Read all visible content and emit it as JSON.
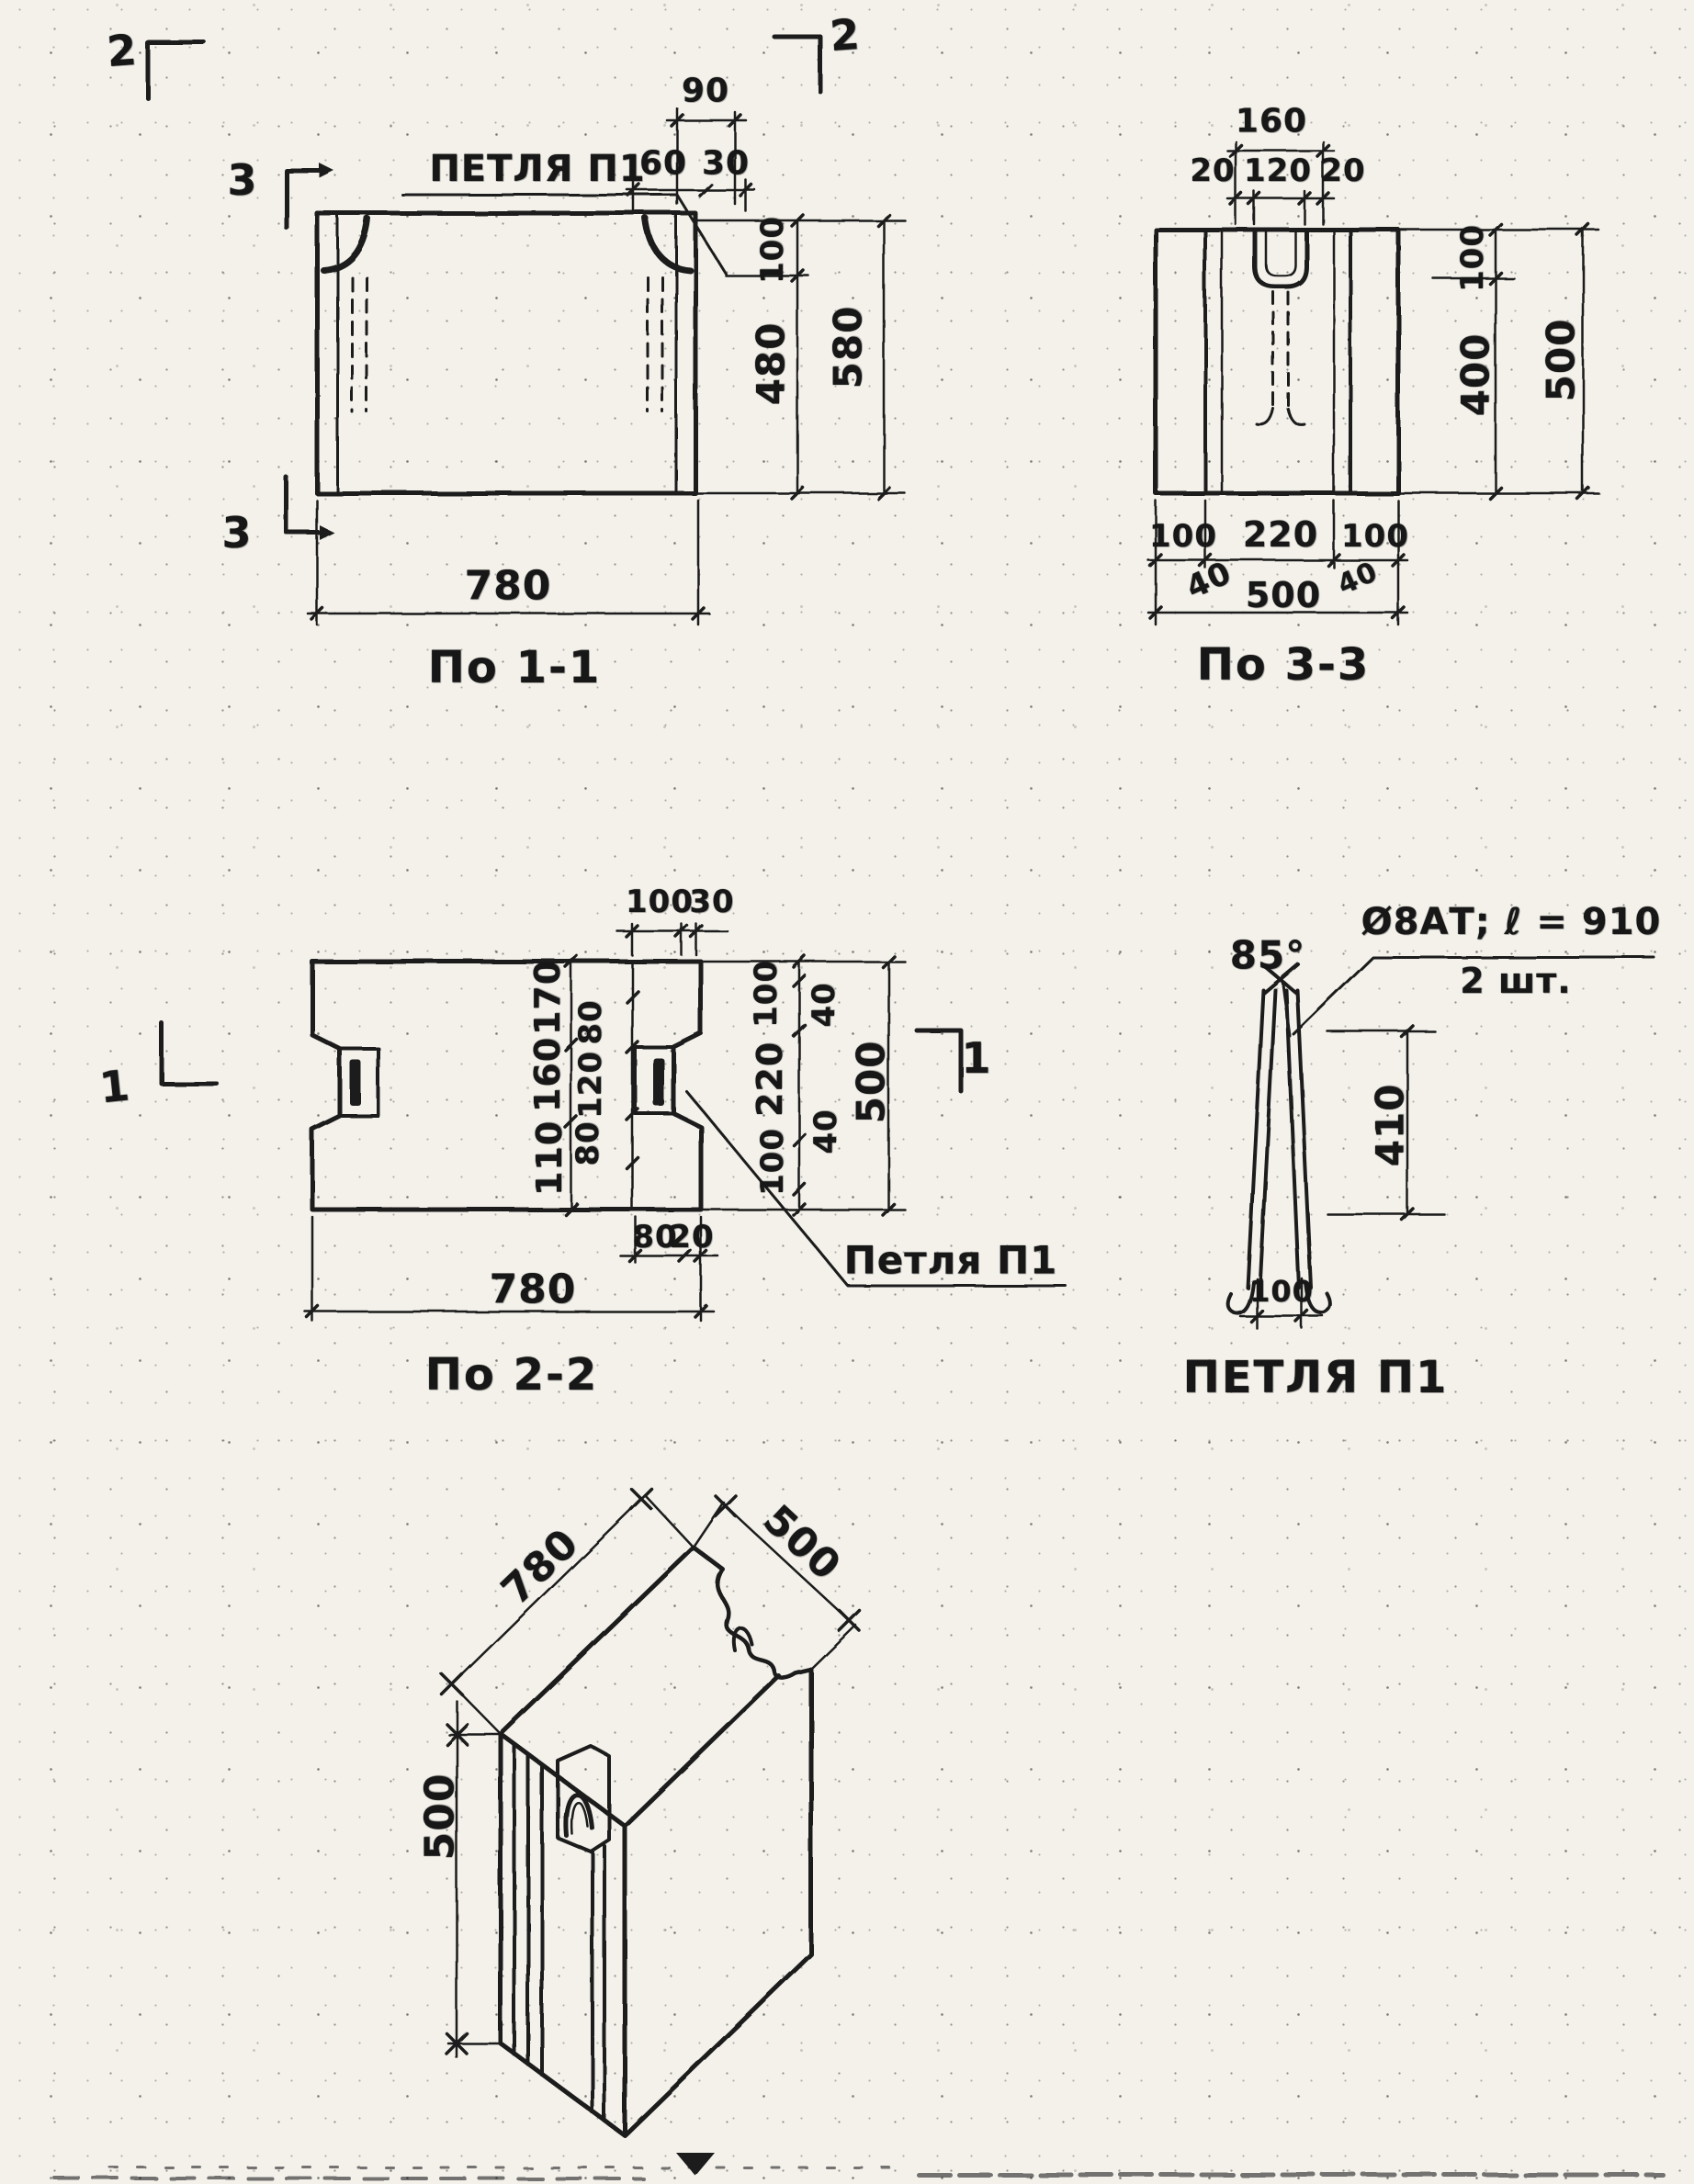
{
  "v1": {
    "title": "По 1-1",
    "loop_label": "ПЕТЛЯ П1",
    "marker_top_left": "2",
    "marker_top_right": "2",
    "marker_side_top": "3",
    "marker_side_bottom": "3",
    "dims": {
      "d90": "90",
      "d60": "60",
      "d30": "30",
      "d100": "100",
      "d480": "480",
      "d580": "580",
      "d780": "780"
    }
  },
  "v2": {
    "title": "По 3-3",
    "dims": {
      "d160": "160",
      "d20l": "20",
      "d120": "120",
      "d20r": "20",
      "d100": "100",
      "d400": "400",
      "d500": "500",
      "b100l": "100",
      "b220": "220",
      "b100r": "100",
      "b40l": "40",
      "b500": "500",
      "b40r": "40"
    }
  },
  "v3": {
    "title": "По 2-2",
    "loop_label": "Петля П1",
    "marker_left": "1",
    "marker_right": "1",
    "dims": {
      "t100": "100",
      "t30": "30",
      "l170": "170",
      "l160": "160",
      "l110": "110",
      "i80t": "80",
      "i120": "120",
      "i80b": "80",
      "r100t": "100",
      "r220": "220",
      "r100b": "100",
      "r40t": "40",
      "r40b": "40",
      "r500": "500",
      "b80": "80",
      "b20": "20",
      "b780": "780"
    }
  },
  "detail": {
    "title": "ПЕТЛЯ П1",
    "angle": "85°",
    "note1": "Ø8АТ; ℓ = 910",
    "note2": "2 шт.",
    "dims": {
      "d410": "410",
      "d100": "100"
    }
  },
  "iso": {
    "dims": {
      "d780": "780",
      "d500r": "500",
      "d500l": "500"
    }
  }
}
